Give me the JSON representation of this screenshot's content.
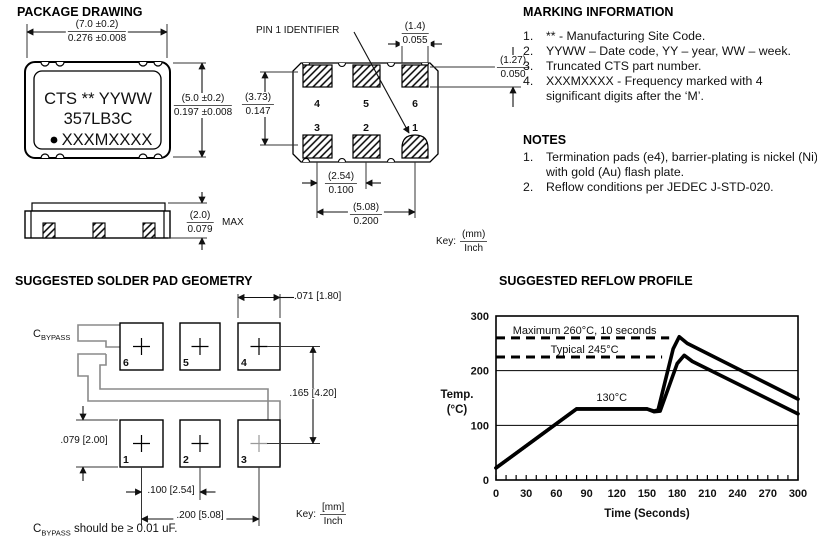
{
  "package_drawing": {
    "title": "PACKAGE DRAWING",
    "chip_marking": {
      "line1": "CTS ** YYWW",
      "line2": "357LB3C",
      "line3": "XXXMXXXX"
    },
    "dims": {
      "width_mm": "(7.0 ±0.2)",
      "width_in": "0.276 ±0.008",
      "height_mm": "(5.0 ±0.2)",
      "height_in": "0.197 ±0.008",
      "thickness_mm": "(2.0)",
      "thickness_in": "0.079",
      "thickness_qualifier": "MAX"
    },
    "land_pattern": {
      "pin1_label": "PIN 1 IDENTIFIER",
      "pad_numbers_top": [
        "4",
        "5",
        "6"
      ],
      "pad_numbers_bottom": [
        "3",
        "2",
        "1"
      ],
      "dims": {
        "pad_width_mm": "(1.4)",
        "pad_width_in": "0.055",
        "pad_height_mm": "(1.27)",
        "pad_height_in": "0.050",
        "row_spacing_mm": "(3.73)",
        "row_spacing_in": "0.147",
        "pad_pitch_mm": "(2.54)",
        "pad_pitch_in": "0.100",
        "pad_span_mm": "(5.08)",
        "pad_span_in": "0.200"
      },
      "key_label": "Key:",
      "key_numerator": "(mm)",
      "key_denominator": "Inch"
    }
  },
  "marking_information": {
    "title": "MARKING INFORMATION",
    "items": [
      {
        "num": "1.",
        "text": "** - Manufacturing Site Code."
      },
      {
        "num": "2.",
        "text": "YYWW – Date code, YY – year, WW – week."
      },
      {
        "num": "3.",
        "text": "Truncated CTS part number."
      },
      {
        "num": "4.",
        "text": "XXXMXXXX - Frequency marked with 4 significant digits after the ‘M’."
      }
    ]
  },
  "notes": {
    "title": "NOTES",
    "items": [
      {
        "num": "1.",
        "text": "Termination pads (e4), barrier-plating is nickel (Ni) with gold (Au) flash plate."
      },
      {
        "num": "2.",
        "text": "Reflow conditions per JEDEC J-STD-020."
      }
    ]
  },
  "solder_pad": {
    "title": "SUGGESTED SOLDER PAD GEOMETRY",
    "cbypass_main": "C",
    "cbypass_sub": "BYPASS",
    "pad_numbers_top": [
      "6",
      "5",
      "4"
    ],
    "pad_numbers_bottom": [
      "1",
      "2",
      "3"
    ],
    "dims": {
      "pad_width": ".071 [1.80]",
      "row_spacing": ".165 [4.20]",
      "pad_height": ".079 [2.00]",
      "pad_pitch": ".100 [2.54]",
      "pad_span": ".200 [5.08]"
    },
    "key_label": "Key:",
    "key_numerator": "[mm]",
    "key_denominator": "Inch",
    "note_main": "C",
    "note_sub": "BYPASS",
    "note_rest": " should be ≥ 0.01 uF."
  },
  "reflow": {
    "title": "SUGGESTED REFLOW PROFILE"
  },
  "chart_data": {
    "type": "line",
    "title": "SUGGESTED REFLOW PROFILE",
    "xlabel": "Time (Seconds)",
    "ylabel_lines": [
      "Temp.",
      "(°C)"
    ],
    "xlim": [
      0,
      300
    ],
    "ylim": [
      0,
      300
    ],
    "xticks": [
      0,
      30,
      60,
      90,
      120,
      150,
      180,
      210,
      240,
      270,
      300
    ],
    "x_minor_step": 10,
    "yticks": [
      0,
      100,
      200,
      300
    ],
    "gridlines_y": [
      100,
      200
    ],
    "legend_position": "none",
    "grid": "horizontal-only",
    "dashed_limits": [
      {
        "label": "Maximum  260°C,  10 seconds",
        "temp_c": 260,
        "line_at": 260,
        "x_start": 0,
        "x_end": 172,
        "label_x": 88,
        "label_y": 274
      },
      {
        "label": "Typical  245°C",
        "temp_c": 245,
        "line_at": 225,
        "x_start": 0,
        "x_end": 165,
        "label_x": 88,
        "label_y": 240
      }
    ],
    "annotations": [
      {
        "text": "130°C",
        "x": 115,
        "y": 152
      }
    ],
    "series": [
      {
        "name": "maximum profile",
        "points": [
          [
            0,
            22
          ],
          [
            80,
            130
          ],
          [
            150,
            130
          ],
          [
            157,
            126
          ],
          [
            161,
            128
          ],
          [
            176,
            240
          ],
          [
            182,
            262
          ],
          [
            190,
            250
          ],
          [
            300,
            148
          ]
        ]
      },
      {
        "name": "typical profile",
        "points": [
          [
            0,
            22
          ],
          [
            80,
            130
          ],
          [
            150,
            130
          ],
          [
            157,
            125
          ],
          [
            163,
            126
          ],
          [
            180,
            213
          ],
          [
            187,
            228
          ],
          [
            195,
            217
          ],
          [
            300,
            121
          ]
        ]
      }
    ]
  }
}
